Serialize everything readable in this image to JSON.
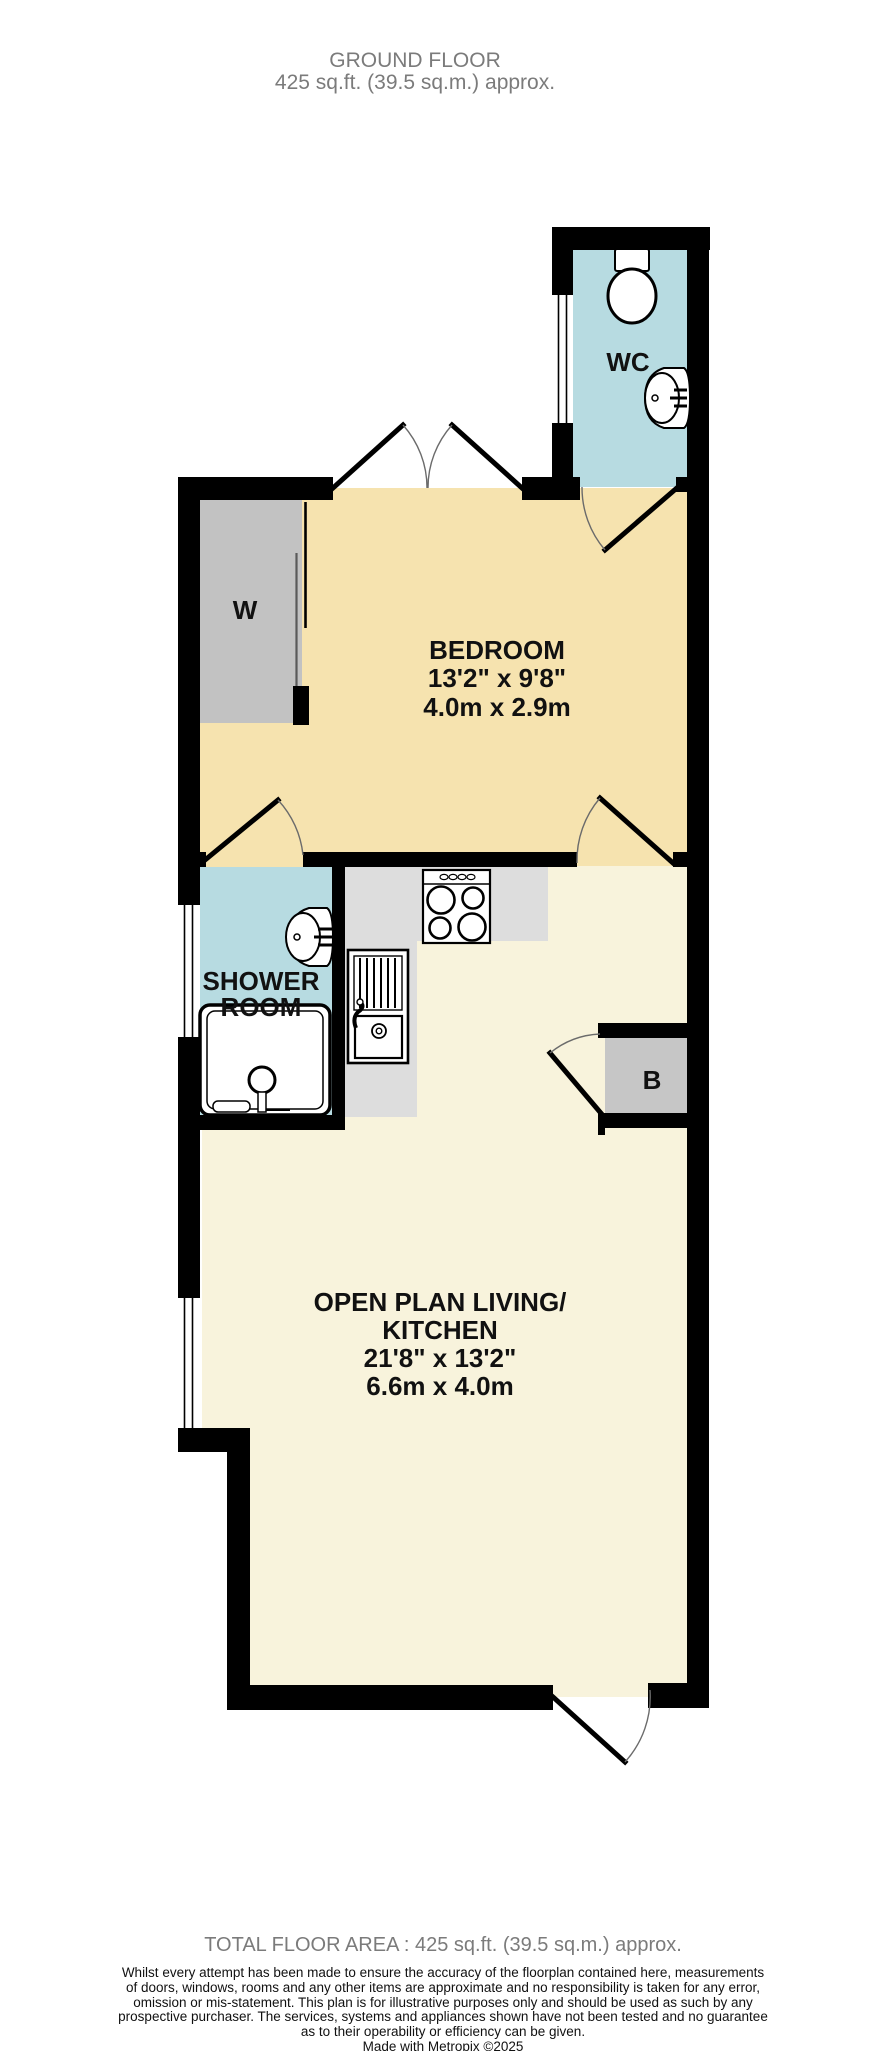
{
  "header": {
    "title": "GROUND FLOOR",
    "subtitle": "425 sq.ft. (39.5 sq.m.) approx."
  },
  "rooms": {
    "wc": {
      "name": "WC"
    },
    "wardrobe": {
      "name": "W"
    },
    "bedroom": {
      "name": "BEDROOM",
      "imperial": "13'2\" x 9'8\"",
      "metric": "4.0m x 2.9m"
    },
    "shower": {
      "name_line1": "SHOWER",
      "name_line2": "ROOM"
    },
    "boiler": {
      "name": "B"
    },
    "living": {
      "name_line1": "OPEN PLAN LIVING/",
      "name_line2": "KITCHEN",
      "imperial": "21'8\" x 13'2\"",
      "metric": "6.6m x 4.0m"
    }
  },
  "footer": {
    "total": "TOTAL FLOOR AREA : 425 sq.ft. (39.5 sq.m.) approx.",
    "disclaimer_lines": [
      "Whilst every attempt has been made to ensure the accuracy of the floorplan contained here, measurements",
      "of doors, windows, rooms and any other items are approximate and no responsibility is taken for any error,",
      "omission or mis-statement. This plan is for illustrative purposes only and should be used as such by any",
      "prospective purchaser. The services, systems and appliances shown have not been tested and no guarantee",
      "as to their operability or efficiency can be given."
    ],
    "credit": "Made with Metropix ©2025"
  },
  "colors": {
    "wall": "#000000",
    "bedroom_floor": "#f6e3af",
    "living_floor": "#f8f3dc",
    "wet_room_floor": "#b7dbe1",
    "wardrobe_fill": "#c2c2c2",
    "boiler_fill": "#c6c6c6",
    "counter_fill": "#dddddd",
    "muted_text": "#7b7b7b"
  }
}
